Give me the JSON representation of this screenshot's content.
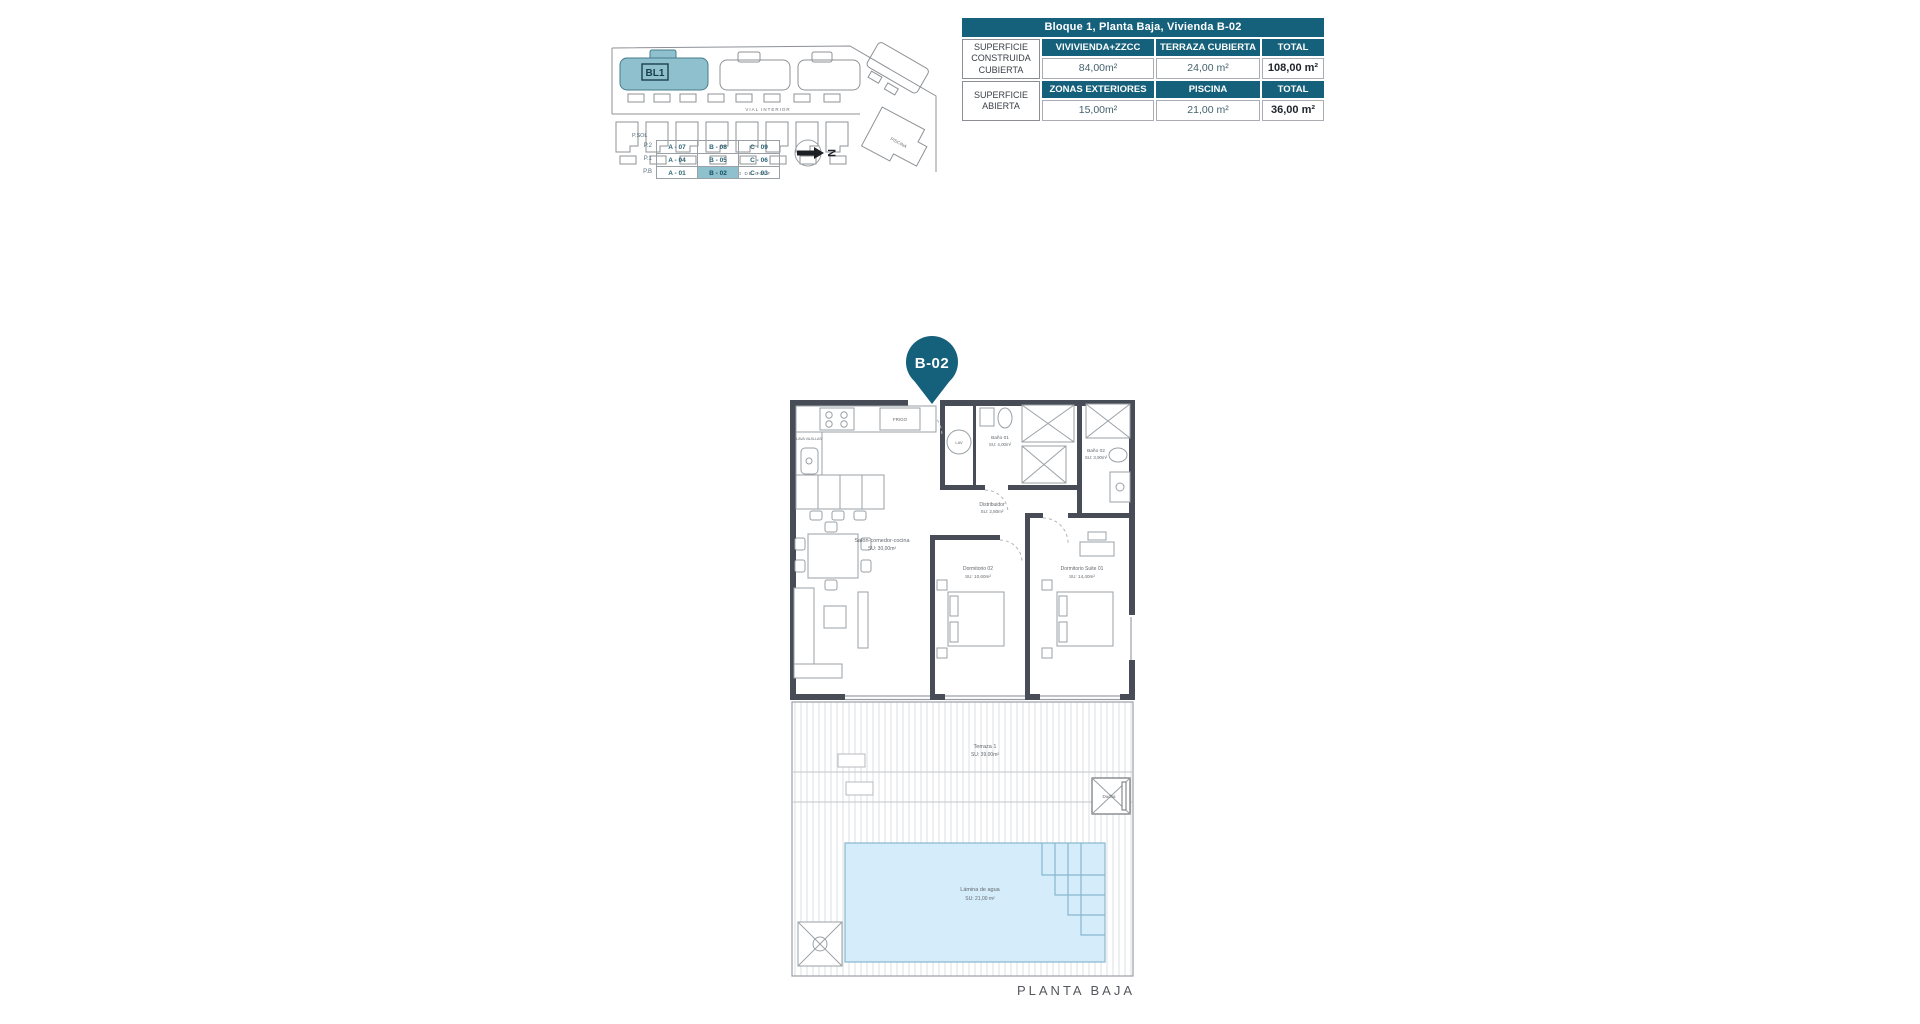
{
  "colors": {
    "teal": "#15607a",
    "teal_light": "#8fc0cd",
    "wall": "#474c56",
    "pool_fill": "#d5edfb",
    "pool_line": "#86b7cf",
    "line_gray": "#9aa0a6"
  },
  "site_plan": {
    "block_label": "BL1",
    "street_top": "VIAL INTERIOR",
    "street_bottom": "CAMPO DE GOLF",
    "facility_label": "PISCINA",
    "north_letter": "N"
  },
  "unit_table": {
    "roof_label": "P.SOL",
    "rows": [
      {
        "level": "P.2",
        "units": [
          "A - 07",
          "B - 08",
          "C - 09"
        ]
      },
      {
        "level": "P.1",
        "units": [
          "A - 04",
          "B - 05",
          "C - 06"
        ]
      },
      {
        "level": "P.B",
        "units": [
          "A - 01",
          "B - 02",
          "C - 03"
        ]
      }
    ],
    "highlighted_unit": "B - 02"
  },
  "area_table": {
    "title": "Bloque 1, Planta Baja, Vivienda B-02",
    "sections": [
      {
        "row_label": "SUPERFICIE CONSTRUIDA CUBIERTA",
        "headers": [
          "VIVIVIENDA+ZZCC",
          "TERRAZA CUBIERTA",
          "TOTAL"
        ],
        "values": [
          "84,00m²",
          "24,00 m²",
          "108,00 m²"
        ]
      },
      {
        "row_label": "SUPERFICIE ABIERTA",
        "headers": [
          "ZONAS EXTERIORES",
          "PISCINA",
          "TOTAL"
        ],
        "values": [
          "15,00m²",
          "21,00 m²",
          "36,00 m²"
        ]
      }
    ]
  },
  "floor_plan": {
    "pin_label": "B-02",
    "caption": "PLANTA BAJA",
    "rooms": {
      "salon": {
        "name": "Salón-comedor-cocina",
        "area": "SU: 30,00m²"
      },
      "distribuidor": {
        "name": "Distribuidor",
        "area": "SU: 2,80m²"
      },
      "bano1": {
        "name": "Baño 01",
        "area": "SU: 4,00m²"
      },
      "bano2": {
        "name": "Baño 02",
        "area": "SU: 3,90m²"
      },
      "dorm2": {
        "name": "Dormitorio 02",
        "area": "SU: 10,60m²"
      },
      "suite": {
        "name": "Dormitorio Suite 01",
        "area": "SU: 14,40m²"
      },
      "terraza": {
        "name": "Terraza 1",
        "area": "SU: 39,00m²"
      },
      "pool": {
        "name": "Lámina de agua",
        "area": "SU: 21,00 m²"
      },
      "ducha": {
        "name": "Ducha"
      }
    },
    "fixtures": {
      "frigo": "FRIGO",
      "lavavajillas": "LAVA VAJILLAS",
      "lav": "LAV"
    }
  }
}
